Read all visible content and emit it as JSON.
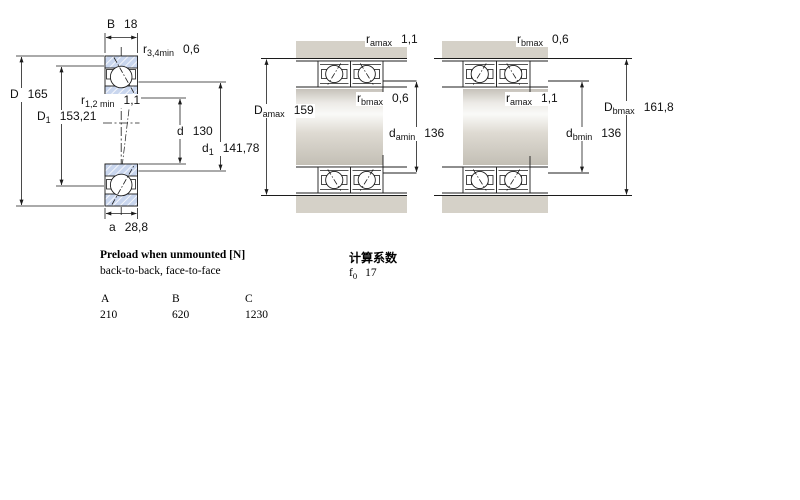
{
  "colors": {
    "ring_hatch_blue": "#c9d6ee",
    "metal_gray": "#d5d1c8",
    "line": "#1c1c1c"
  },
  "left_diagram": {
    "labels": {
      "B": {
        "main": "B",
        "sub": "",
        "value": "18"
      },
      "r34": {
        "main": "r",
        "sub": "3,4min",
        "value": "0,6"
      },
      "D": {
        "main": "D",
        "sub": "",
        "value": "165"
      },
      "r12": {
        "main": "r",
        "sub": "1,2 min",
        "value": "1,1"
      },
      "D1": {
        "main": "D",
        "sub": "1",
        "value": "153,21"
      },
      "d": {
        "main": "d",
        "sub": "",
        "value": "130"
      },
      "d1": {
        "main": "d",
        "sub": "1",
        "value": "141,78"
      },
      "a": {
        "main": "a",
        "sub": "",
        "value": "28,8"
      }
    }
  },
  "middle_diagram": {
    "labels": {
      "ramax": {
        "main": "r",
        "sub": "amax",
        "value": "1,1"
      },
      "Damax": {
        "main": "D",
        "sub": "amax",
        "value": "159"
      },
      "rbmax": {
        "main": "r",
        "sub": "bmax",
        "value": "0,6"
      },
      "damin": {
        "main": "d",
        "sub": "amin",
        "value": "136"
      }
    }
  },
  "right_diagram": {
    "labels": {
      "rbmax": {
        "main": "r",
        "sub": "bmax",
        "value": "0,6"
      },
      "ramax": {
        "main": "r",
        "sub": "amax",
        "value": "1,1"
      },
      "Dbmax": {
        "main": "D",
        "sub": "bmax",
        "value": "161,8"
      },
      "dbmin": {
        "main": "d",
        "sub": "bmin",
        "value": "136"
      }
    }
  },
  "preload": {
    "title": "Preload when unmounted [N]",
    "subtitle": "back-to-back, face-to-face",
    "columns": [
      "A",
      "B",
      "C"
    ],
    "values": [
      "210",
      "620",
      "1230"
    ]
  },
  "calculation": {
    "title": "计算系数",
    "factor": {
      "main": "f",
      "sub": "0",
      "value": "17"
    }
  }
}
